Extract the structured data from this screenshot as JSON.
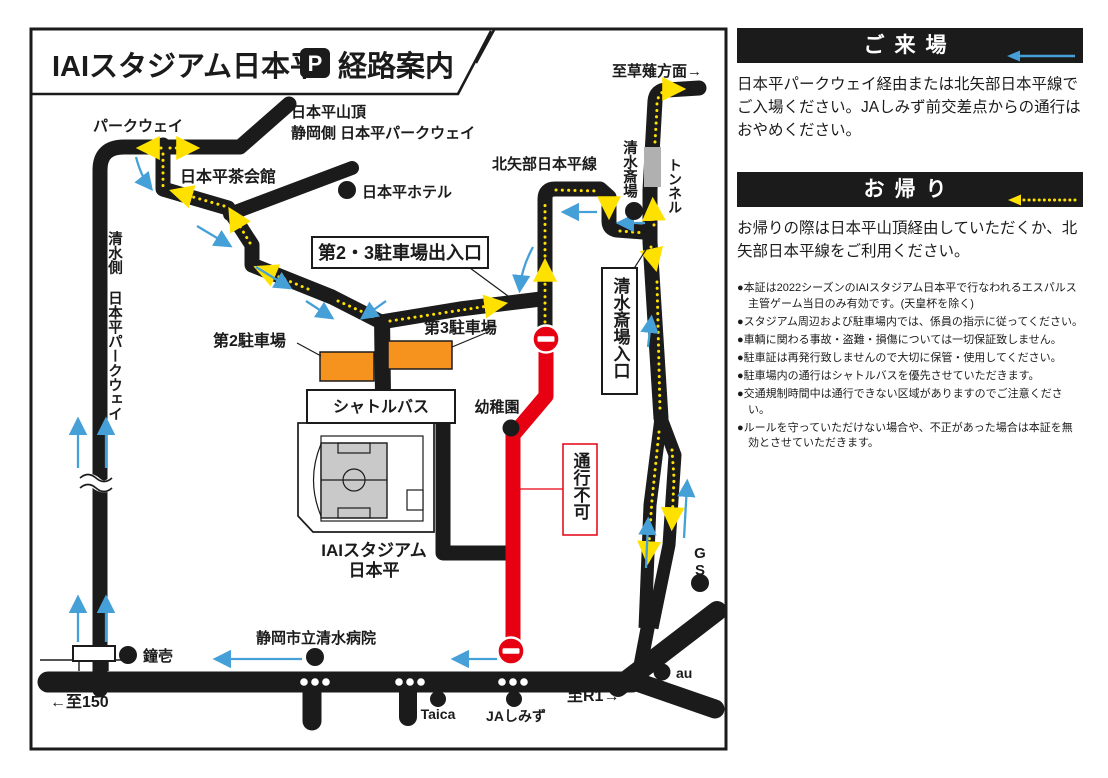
{
  "title": {
    "main": "IAIスタジアム日本平",
    "p_badge": "P",
    "suffix": "経路案内"
  },
  "map": {
    "labels": {
      "parkway": "パークウェイ",
      "summit_line1": "日本平山頂",
      "summit_line2": "静岡側 日本平パークウェイ",
      "chakaikan": "日本平茶会館",
      "hotel": "日本平ホテル",
      "kusanagi": "至草薙方面→",
      "kitayabe": "北矢部日本平線",
      "saijo": "清水斎場",
      "tunnel": "トンネル",
      "shimizu_side": "清水側 日本平パークウェイ",
      "gate23": "第2・3駐車場出入口",
      "p2": "第2駐車場",
      "p3": "第3駐車場",
      "shuttle": "シャトルバス",
      "saijo_entrance": "清水斎場入口",
      "kindergarten": "幼稚園",
      "no_passage": "通行不可",
      "stadium_line1": "IAIスタジアム",
      "stadium_line2": "日本平",
      "gs": "GS",
      "kanekichi": "鐘壱",
      "to150": "←至150",
      "hospital": "静岡市立清水病院",
      "taica": "Taica",
      "ja_shimizu": "JAしみず",
      "toR1": "至R1→",
      "au": "au"
    },
    "colors": {
      "road": "#1b1b1b",
      "closed_road": "#e60012",
      "arrival_arrow": "#45a0d8",
      "departure_arrow": "#ffe100",
      "parking_lot": "#f6921e",
      "tunnel_segment": "#b0b0b0",
      "pitch": "#c9c9c9"
    }
  },
  "panel": {
    "arrival": {
      "title": "ご来場",
      "body": "日本平パークウェイ経由または北矢部日本平線でご入場ください。JAしみず前交差点からの通行はおやめください。"
    },
    "departure": {
      "title": "お帰り",
      "body": "お帰りの際は日本平山頂経由していただくか、北矢部日本平線をご利用ください。"
    },
    "notes": [
      "●本証は2022シーズンのIAIスタジアム日本平で行なわれるエスパルス主管ゲーム当日のみ有効です。(天皇杯を除く)",
      "●スタジアム周辺および駐車場内では、係員の指示に従ってください。",
      "●車輌に関わる事故・盗難・損傷については一切保証致しません。",
      "●駐車証は再発行致しませんので大切に保管・使用してください。",
      "●駐車場内の通行はシャトルバスを優先させていただきます。",
      "●交通規制時間中は通行できない区域がありますのでご注意ください。",
      "●ルールを守っていただけない場合や、不正があった場合は本証を無効とさせていただきます。"
    ]
  }
}
